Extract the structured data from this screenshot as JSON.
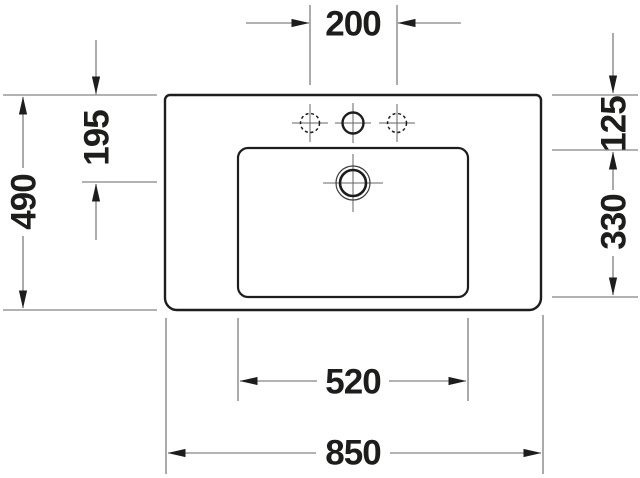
{
  "drawing": {
    "dims": {
      "top_center": "200",
      "left_overall": "490",
      "left_upper": "195",
      "right_upper": "125",
      "right_lower": "330",
      "bottom_inner": "520",
      "bottom_overall": "850"
    },
    "colors": {
      "outline": "#1d1d1b",
      "dimension_lines": "#666666",
      "background": "#ffffff"
    }
  }
}
